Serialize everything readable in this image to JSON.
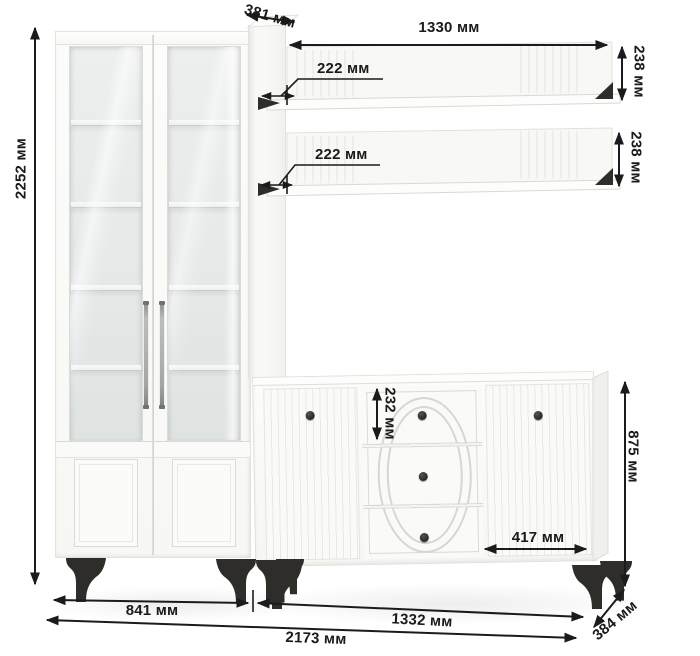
{
  "diagram": {
    "unit": "мм",
    "dimensions": {
      "total_height": "2252 мм",
      "upper_depth": "381 мм",
      "shelf_width": "1330 мм",
      "shelf_depth_upper": "222 мм",
      "shelf_depth_lower": "222 мм",
      "shelf_height_upper": "238 мм",
      "shelf_height_lower": "238 мм",
      "drawer_height": "232 мм",
      "sideboard_height": "875 мм",
      "sideboard_door_width": "417 мм",
      "cabinet_width": "841 мм",
      "sideboard_width": "1332 мм",
      "total_width": "2173 мм",
      "sideboard_depth": "384 мм"
    },
    "colors": {
      "background": "#ffffff",
      "furniture_white": "#f9f9f6",
      "dimension_lines": "#1b1b1b",
      "hardware_black": "#2e2d2a",
      "glass_tint": "#e6e9e8"
    }
  }
}
